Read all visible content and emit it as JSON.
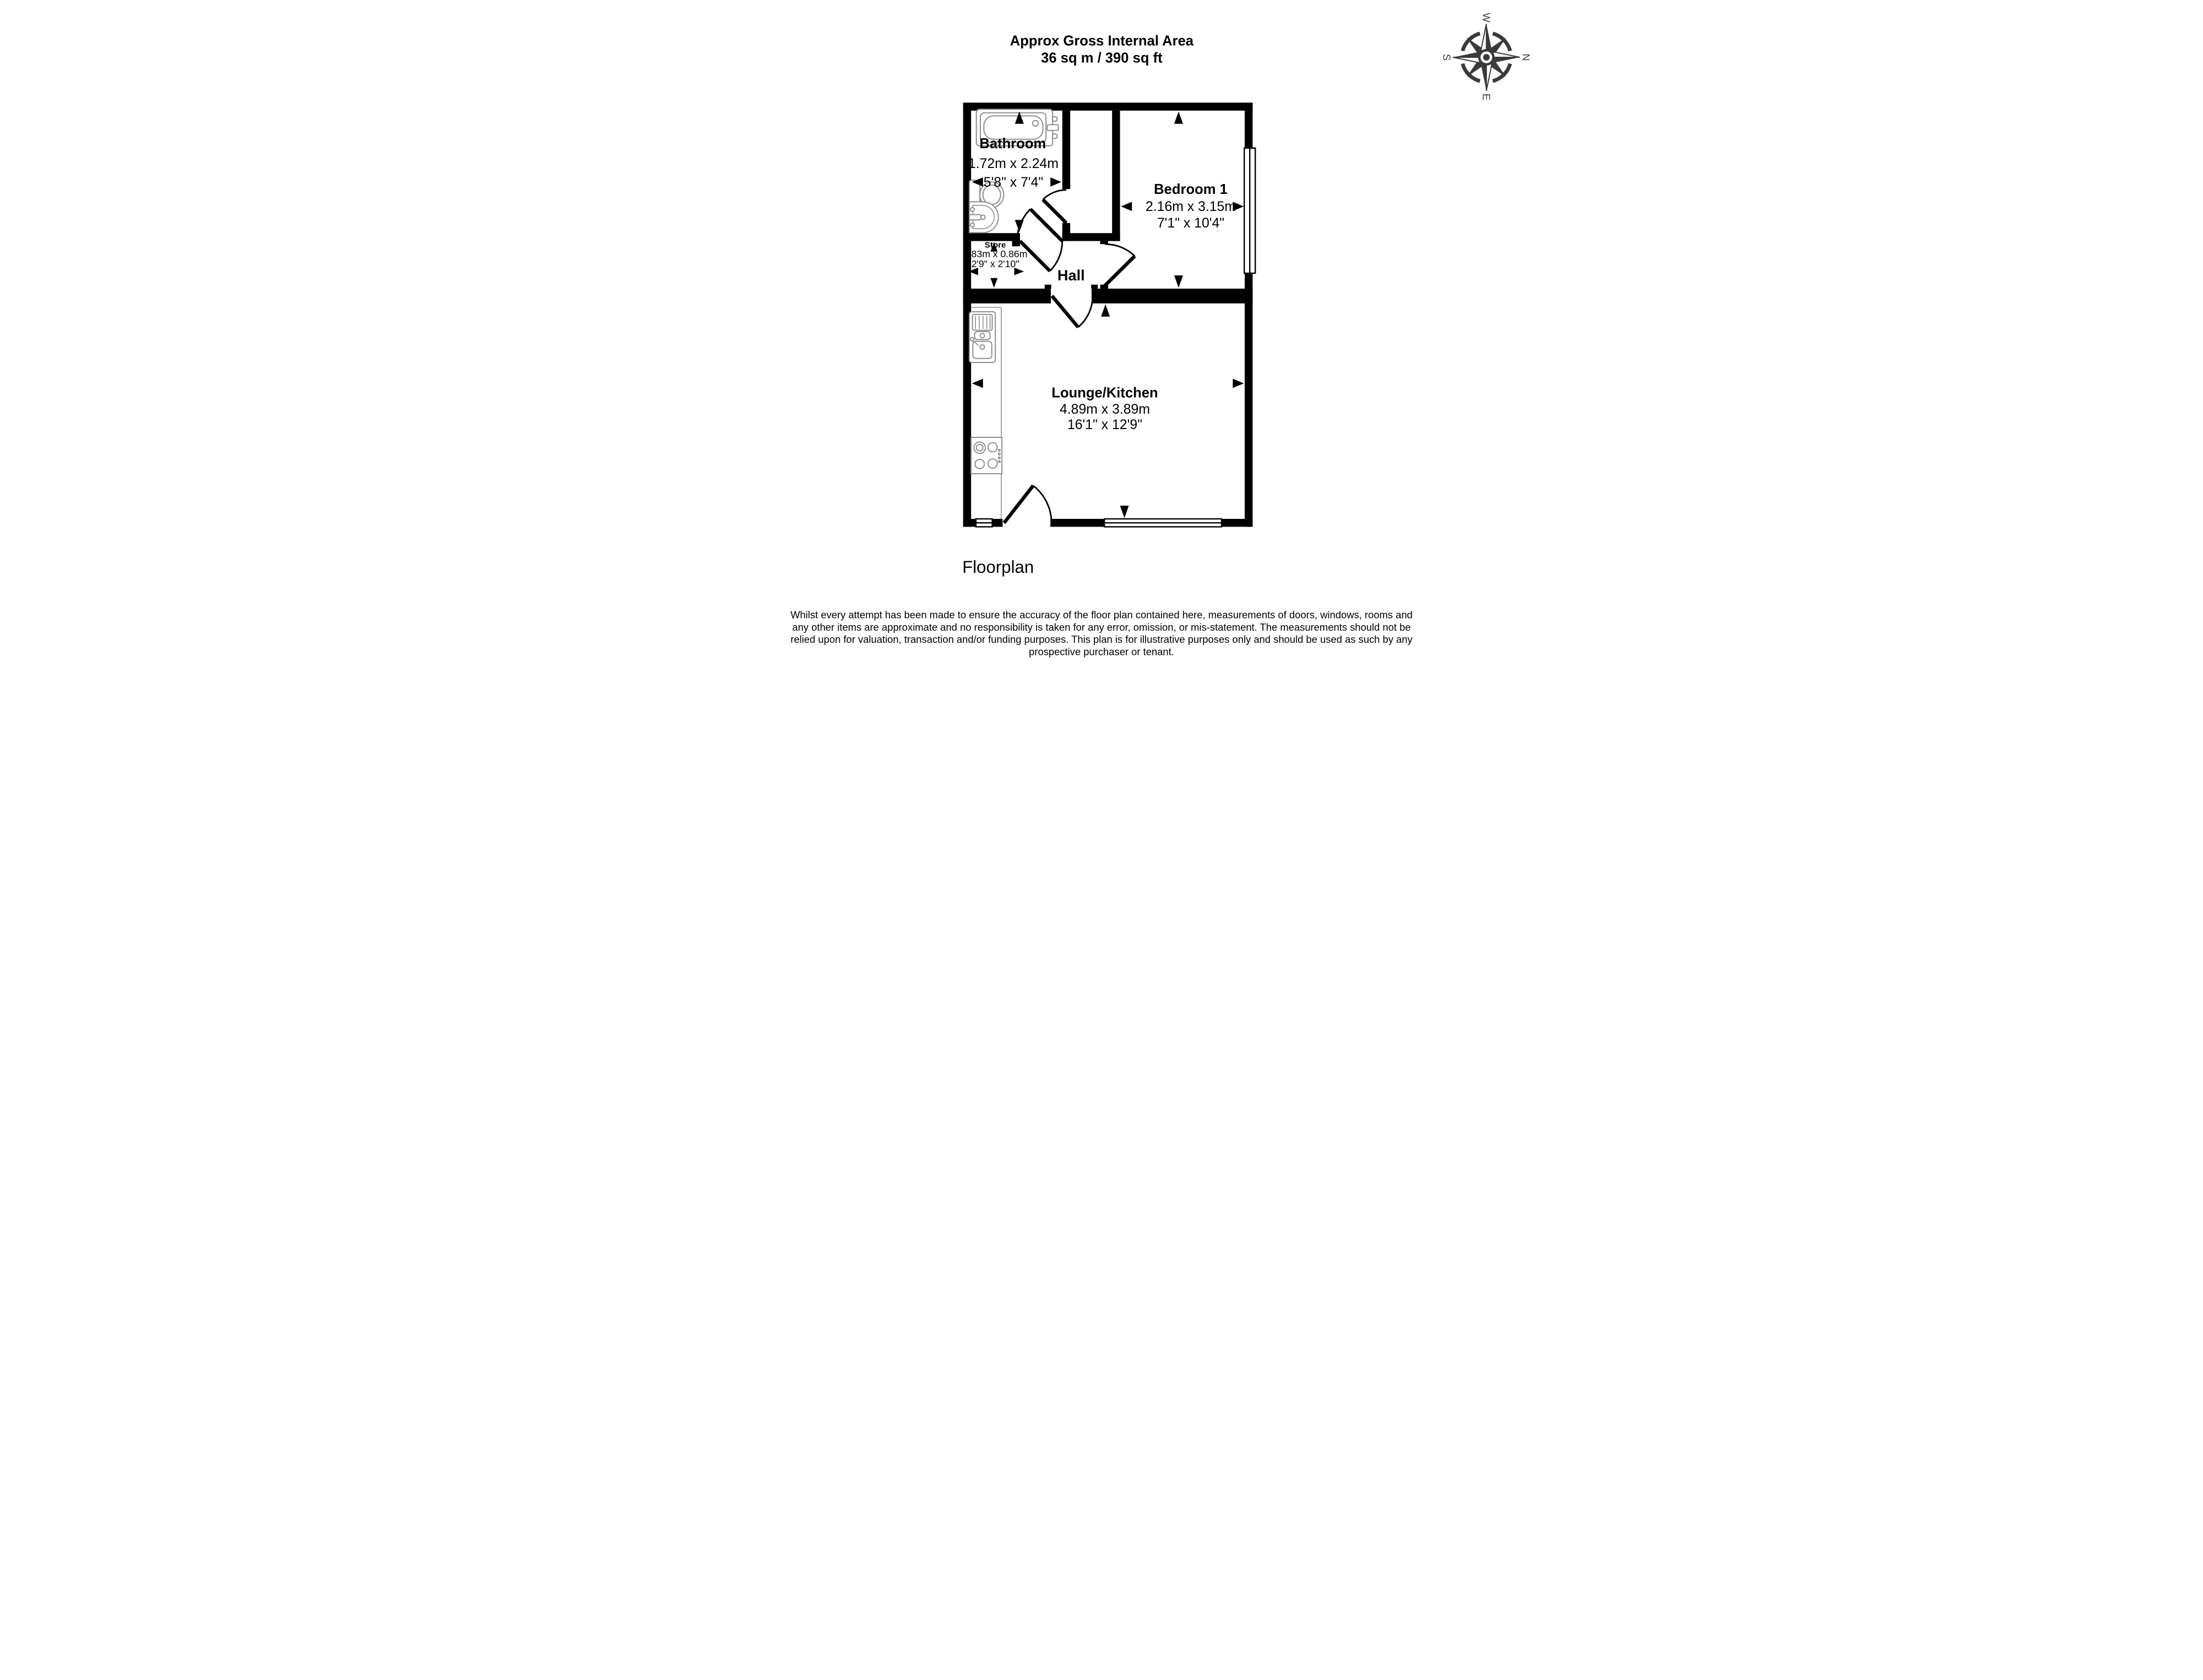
{
  "header": {
    "title_line1": "Approx Gross Internal Area",
    "title_line2": "36 sq m / 390 sq ft"
  },
  "compass": {
    "north": "N",
    "east": "E",
    "south": "S",
    "west": "W",
    "color": "#3a3a3a"
  },
  "rooms": {
    "bathroom": {
      "name": "Bathroom",
      "metric": "1.72m x 2.24m",
      "imperial": "5'8\" x 7'4\""
    },
    "bedroom": {
      "name": "Bedroom 1",
      "metric": "2.16m x 3.15m",
      "imperial": "7'1\" x 10'4\""
    },
    "store": {
      "name": "Store",
      "metric": "0.83m x 0.86m",
      "imperial": "2'9\" x 2'10\""
    },
    "hall": {
      "name": "Hall"
    },
    "lounge": {
      "name": "Lounge/Kitchen",
      "metric": "4.89m x 3.89m",
      "imperial": "16'1\" x 12'9\""
    }
  },
  "footer": {
    "caption": "Floorplan",
    "disclaimer_lines": [
      "Whilst every attempt has been made to ensure the accuracy of the floor plan contained here, measurements of doors, windows, rooms and",
      "any other items are approximate and no responsibility is taken for any error, omission, or mis-statement. The measurements should not be",
      "relied upon for valuation, transaction and/or funding purposes. This plan is for illustrative purposes only and should be used as such by any",
      "prospective purchaser or tenant."
    ]
  },
  "colors": {
    "wall": "#000000",
    "fixture_outline": "#8f8f8f",
    "background": "#ffffff"
  }
}
